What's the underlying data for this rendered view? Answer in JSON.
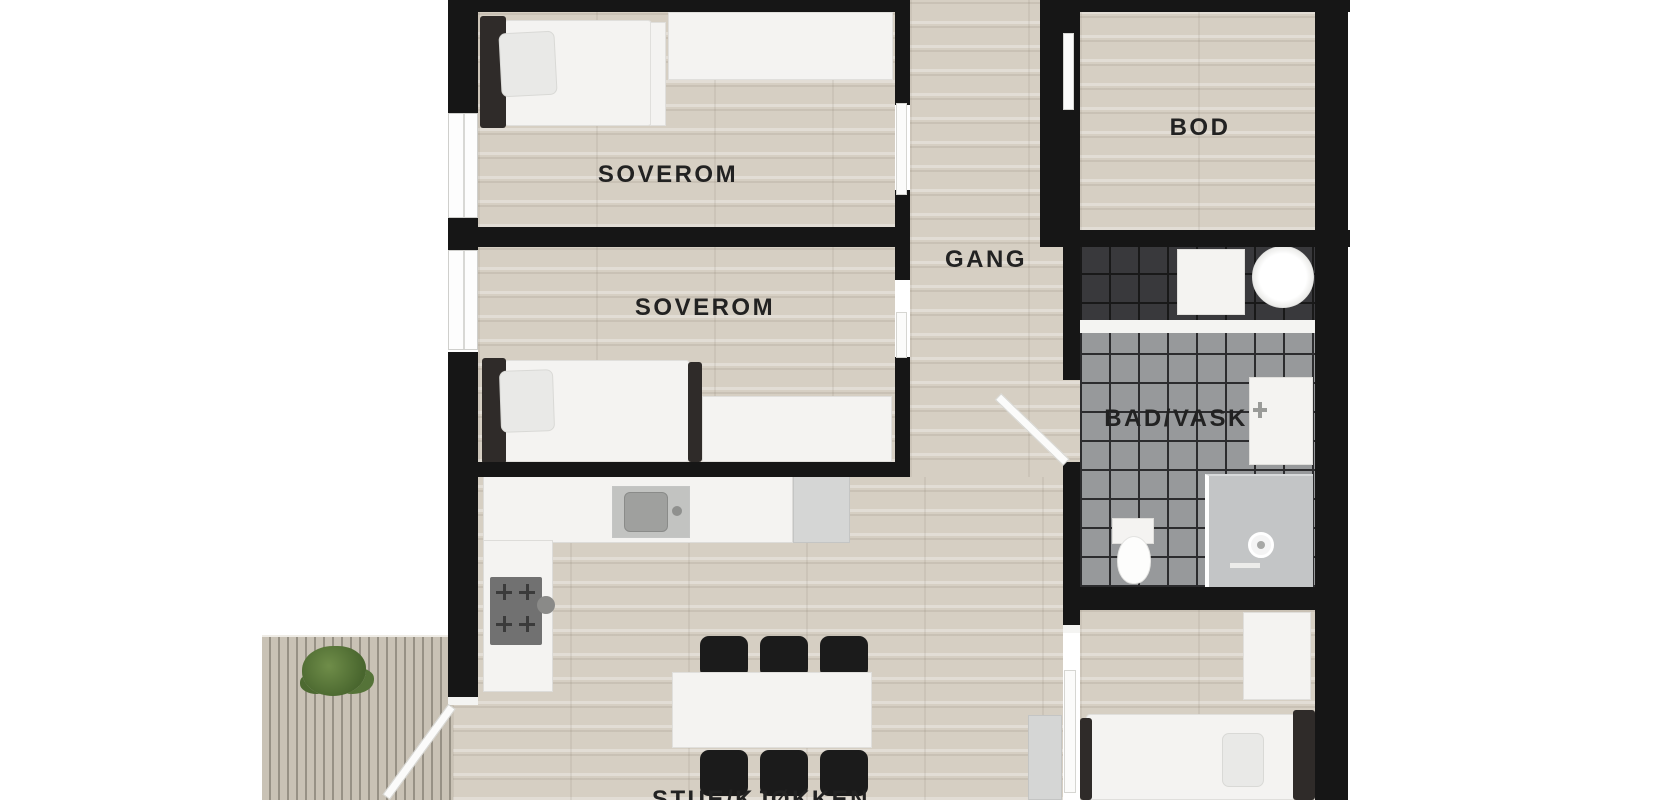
{
  "floorplan": {
    "type": "apartment-floor-plan-top-view",
    "labels": {
      "bedroom1": "SOVEROM",
      "bedroom2": "SOVEROM",
      "hallway": "GANG",
      "storage": "BOD",
      "bathroom": "BAD/VASK",
      "living_kitchen": "STUE/KJØKKEN"
    },
    "colors": {
      "wall": "#161616",
      "wood_floor": "#d6cfc3",
      "deck": "#c9c2b5",
      "tile_floor": "#97999b",
      "tile_dark": "#39393c",
      "furniture_white": "#f4f3f1",
      "furniture_dark": "#2f2b29",
      "chair_black": "#1b1b1b",
      "plant_green": "#6f8d49",
      "label_text": "#222222"
    }
  }
}
